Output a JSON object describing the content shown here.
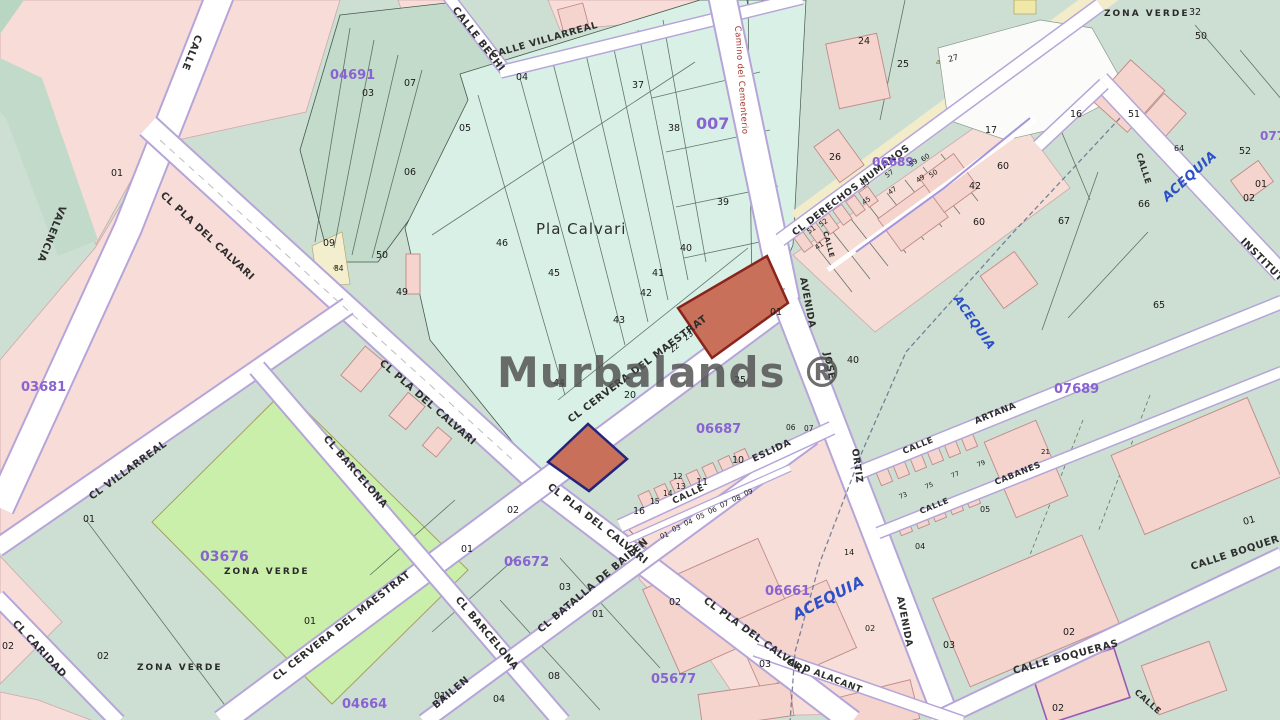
{
  "map": {
    "watermark": "Murbalands ®",
    "camino": "Camino del Cementerio",
    "streets": [
      "CALLE",
      "VALENCIA",
      "CALLE BECHI",
      "CALLE VILLARREAL",
      "CL DERECHOS HUMANOS",
      "CL PLA DEL CALVARI",
      "CL PLA DEL CALVARI",
      "CL PLA DEL CALVARI",
      "CL PLA DEL CALVARI",
      "CL VILLARREAL",
      "CL BARCELONA",
      "CL BARCELONA",
      "CL CERVERA DEL MAESTRAT",
      "CL CERVERA DEL MAESTRAT",
      "CL BATALLA DE BAILEN",
      "BAILEN",
      "CL CARIDAD",
      "CALLE",
      "ESLIDA",
      "CALLE",
      "ARTANA",
      "CALLE",
      "CABANES",
      "AVENIDA",
      "JOSE",
      "ORTIZ",
      "AVENIDA",
      "CL D ALACANT",
      "CALLE BOQUERAS",
      "CALLE BOQUERAS",
      "CALLE",
      "INSTITUT",
      "CALLE",
      "CALLE"
    ],
    "areas": [
      "Pla Calvari",
      "ZONA VERDE",
      "ZONA VERDE",
      "ZONA VERDE"
    ],
    "codes": [
      "04691",
      "007",
      "03681",
      "03676",
      "06672",
      "05677",
      "06687",
      "06661",
      "06689",
      "07689",
      "04664",
      "077"
    ],
    "water": [
      "ACEQUIA",
      "ACEQUIA",
      "ACEQUIA"
    ],
    "letters": [
      "a",
      "a"
    ],
    "nums": [
      "03",
      "07",
      "04",
      "05",
      "06",
      "09",
      "50",
      "84",
      "49",
      "01",
      "37",
      "38",
      "39",
      "40",
      "41",
      "42",
      "43",
      "44",
      "45",
      "46",
      "20",
      "23",
      "22",
      "25",
      "01",
      "24",
      "25",
      "27",
      "26",
      "17",
      "16",
      "60",
      "42",
      "60",
      "67",
      "51",
      "50",
      "32",
      "66",
      "52",
      "01",
      "02",
      "65",
      "64",
      "40",
      "10",
      "11",
      "12",
      "13",
      "14",
      "15",
      "16",
      "01",
      "03",
      "04",
      "05",
      "06",
      "07",
      "08",
      "09",
      "06",
      "07",
      "02",
      "01",
      "03",
      "02",
      "01",
      "08",
      "01",
      "04",
      "03",
      "02",
      "02",
      "01",
      "01",
      "01",
      "02",
      "03",
      "02",
      "05",
      "04",
      "14",
      "02",
      "21",
      "51",
      "52",
      "55",
      "57",
      "59",
      "60",
      "41",
      "45",
      "47",
      "49",
      "50",
      "73",
      "75",
      "77",
      "79"
    ],
    "colors": {
      "base": "#ccdfd2",
      "aqua_zone": "#d9f0e7",
      "pink_block": "#f8dcd8",
      "green_zone": "#c9efaa",
      "cream_strip": "#f2eccb",
      "road_casing": "#b5a5d8",
      "zone_code": "#8a63d2",
      "water_label": "#2b50c8",
      "camino_label": "#a5372c",
      "highlight_parcel_fill": "#c8705a",
      "highlight_parcel_stroke_red": "#8a241c",
      "highlight_parcel_stroke_navy": "#24247a"
    }
  }
}
